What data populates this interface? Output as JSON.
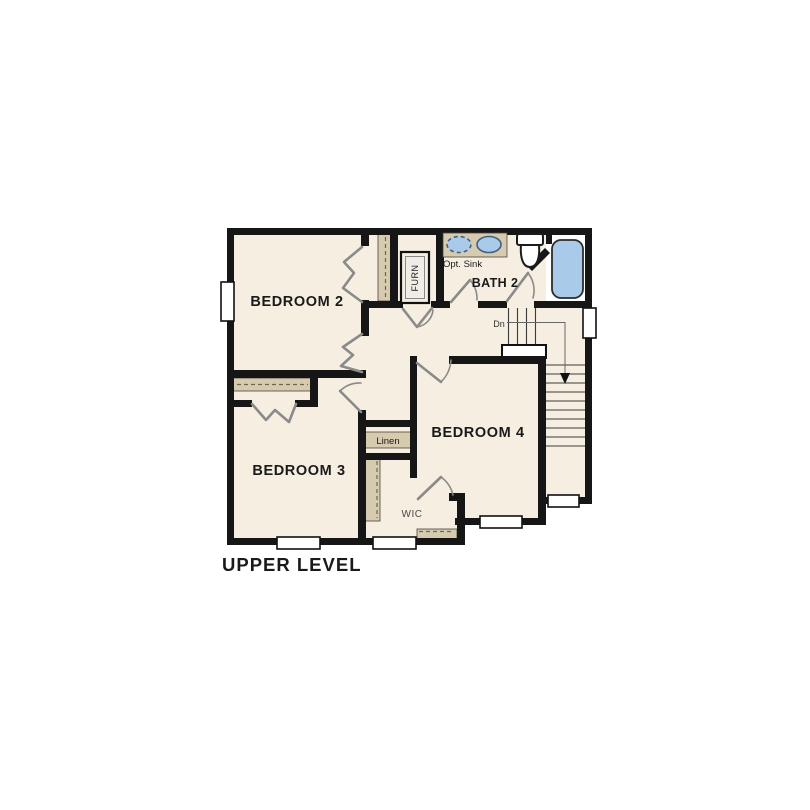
{
  "plan": {
    "title": "UPPER LEVEL",
    "rooms": {
      "bedroom2": "BEDROOM 2",
      "bedroom3": "BEDROOM 3",
      "bedroom4": "BEDROOM 4",
      "bath2": "BATH 2"
    },
    "fixtures": {
      "furnace": "FURN",
      "optional_sink": "Opt. Sink",
      "linen": "Linen",
      "walk_in_closet": "WIC",
      "stairs_down": "Dn"
    },
    "colors": {
      "floor": "#f5eee1",
      "wall": "#161616",
      "shelf": "#d6caaf",
      "shelf_line": "#6f6754",
      "fixture_blue": "#aacae9",
      "fixture_blue_border": "#44617e",
      "door": "#8a8a8a",
      "stair_line": "#3a3a3a",
      "text": "#1a1a1a"
    }
  }
}
